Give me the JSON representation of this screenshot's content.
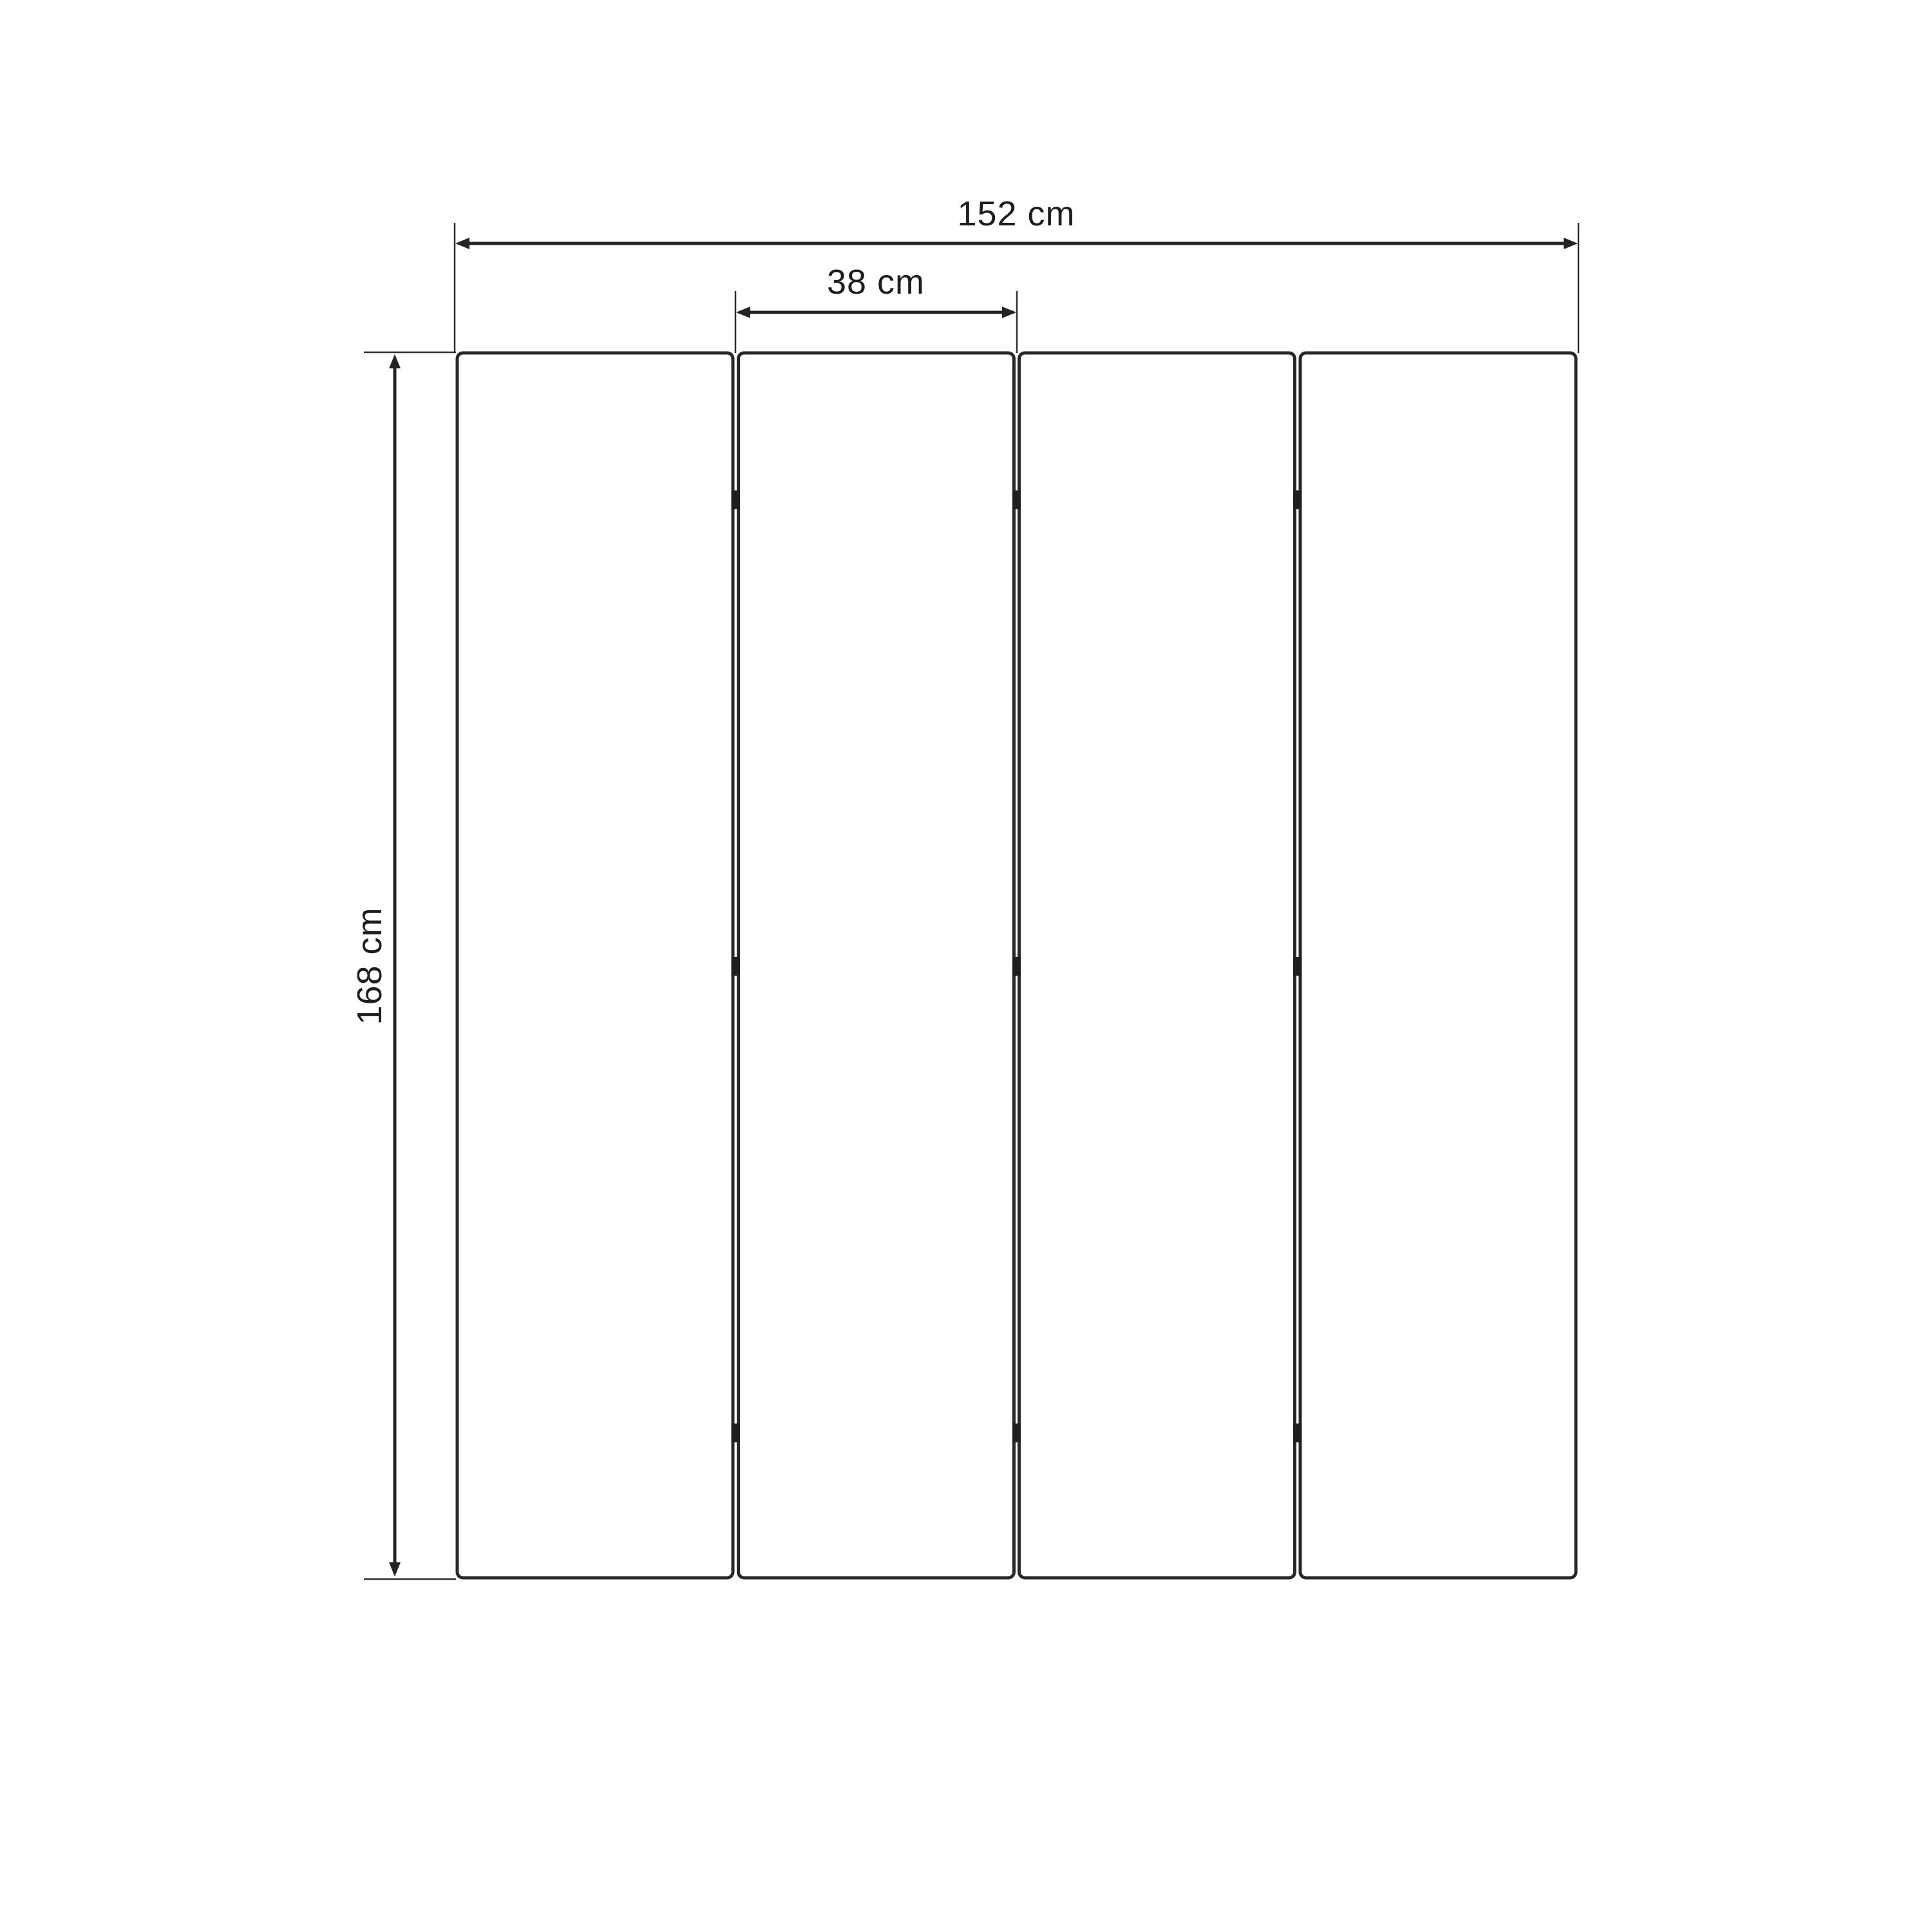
{
  "diagram": {
    "type": "dimension-drawing",
    "unit": "cm",
    "panel_count": 4,
    "hinge_marks_per_gap": 3,
    "dimensions": {
      "total_width": {
        "value": 152,
        "label": "152 cm"
      },
      "panel_width": {
        "value": 38,
        "label": "38 cm"
      },
      "height": {
        "value": 168,
        "label": "168 cm"
      }
    },
    "colors": {
      "background": "#ffffff",
      "line": "#232323",
      "panel_stroke": "#282828",
      "text": "#1d1d1d"
    }
  }
}
